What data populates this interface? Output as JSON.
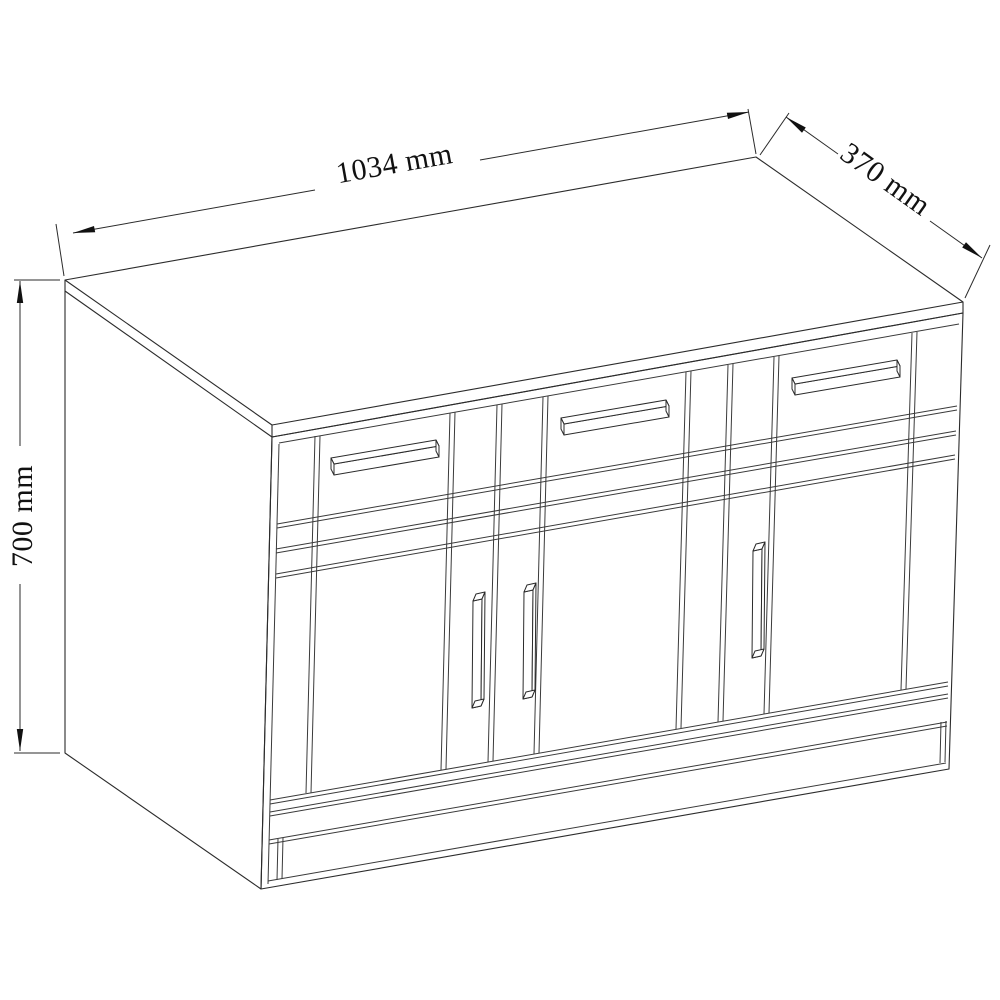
{
  "diagram": {
    "object": "sideboard cabinet line drawing",
    "view": "perspective front-left-top",
    "dimensions": {
      "width": {
        "label": "1034 mm",
        "value": 1034,
        "unit": "mm"
      },
      "depth": {
        "label": "370 mm",
        "value": 370,
        "unit": "mm"
      },
      "height": {
        "label": "700 mm",
        "value": 700,
        "unit": "mm"
      }
    },
    "features": {
      "drawer_count": 3,
      "door_count": 3,
      "drawer_handle_style": "horizontal bar",
      "door_handle_style": "vertical bar"
    },
    "colors": {
      "line": "#2b2b2b",
      "background": "#ffffff",
      "text": "#111111"
    }
  }
}
